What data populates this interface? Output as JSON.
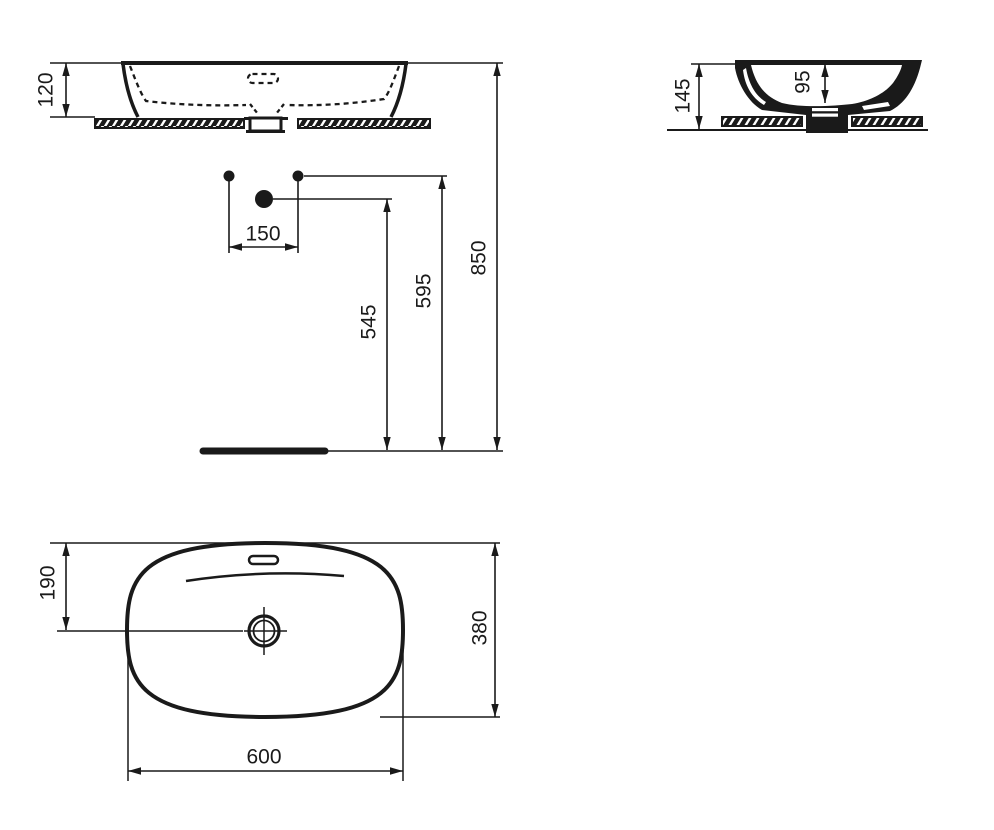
{
  "drawing": {
    "front_view": {
      "dims": {
        "basin_height": "120",
        "tap_hole_spacing": "150",
        "trap_height": "545",
        "rim_outlet_height": "595",
        "total_height": "850"
      }
    },
    "side_view": {
      "dims": {
        "overall_depth": "145",
        "bowl_depth": "95"
      }
    },
    "plan_view": {
      "dims": {
        "drain_offset": "190",
        "depth": "380",
        "width": "600"
      }
    },
    "colors": {
      "line": "#1a1a1a",
      "background": "#ffffff"
    }
  }
}
